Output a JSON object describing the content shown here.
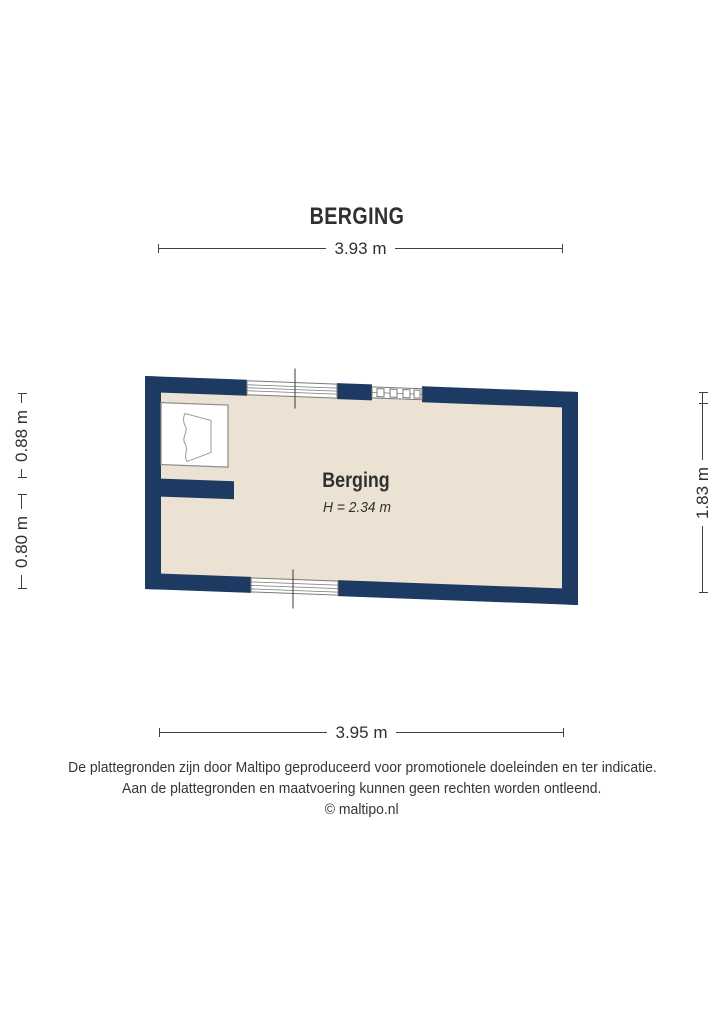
{
  "title": "BERGING",
  "dimensions": {
    "top": "3.93 m",
    "bottom": "3.95 m",
    "left_upper": "0.88 m",
    "left_lower": "0.80 m",
    "right": "1.83 m"
  },
  "room": {
    "name": "Berging",
    "height_label": "H = 2.34 m"
  },
  "footer": {
    "line1": "De plattegronden zijn door Maltipo geproduceerd voor promotionele doeleinden en ter indicatie.",
    "line2": "Aan de plattegronden en maatvoering kunnen geen rechten worden ontleend.",
    "line3": "© maltipo.nl"
  },
  "colors": {
    "wall": "#1d3a63",
    "floor": "#ece2d3",
    "outline": "#7a7a7a",
    "text": "#303030"
  }
}
